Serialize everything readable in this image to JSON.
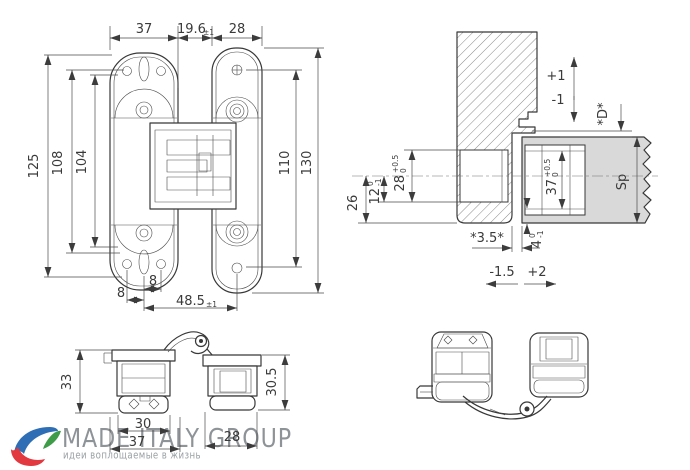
{
  "drawing": {
    "front_view": {
      "dim_top_left_leaf_width": "37",
      "dim_top_gap": "19.6",
      "dim_top_gap_tol": "±1",
      "dim_top_right_leaf_width": "28",
      "dim_left_overall": "125",
      "dim_left_holes": "108",
      "dim_left_inner": "104",
      "dim_right_holes": "110",
      "dim_right_overall": "130",
      "dim_bottom_offset_upper": "8",
      "dim_bottom_offset_lower": "8",
      "dim_bottom_span": "48.5",
      "dim_bottom_span_tol": "±1"
    },
    "section_view": {
      "vertical_adjust_plus": "+1",
      "vertical_adjust_minus": "-1",
      "depth_label": "*D*",
      "dim_26": "26",
      "dim_12": "12",
      "dim_12_tol_up": "0",
      "dim_12_tol_dn": "-1",
      "dim_28": "28",
      "dim_28_tol_up": "+0.5",
      "dim_28_tol_dn": "0",
      "dim_37": "37",
      "dim_37_tol_up": "+0.5",
      "dim_37_tol_dn": "0",
      "door_thickness_label": "Sp",
      "dim_gap": "*3.5*",
      "dim_4": "4",
      "dim_4_tol_up": "0",
      "dim_4_tol_dn": "-1",
      "lateral_adjust_minus": "-1.5",
      "lateral_adjust_plus": "+2"
    },
    "side_view": {
      "dim_height_left": "33",
      "dim_width_inner": "30",
      "dim_width_outer": "37",
      "dim_width_right": "28",
      "dim_height_right": "30.5"
    }
  },
  "logo": {
    "title": "MADE ITALY GROUP",
    "tagline": "идеи воплощаемые в жизнь",
    "title_color": "#8e9397",
    "icon_colors": {
      "blue": "#2e6eb5",
      "red": "#e2383f",
      "green": "#3e9c49"
    }
  },
  "colors": {
    "background": "#ffffff",
    "line": "#383838",
    "dimension": "#4a4a4a",
    "door_fill": "#d9d9d9",
    "hatch": "#8a8a8a"
  }
}
